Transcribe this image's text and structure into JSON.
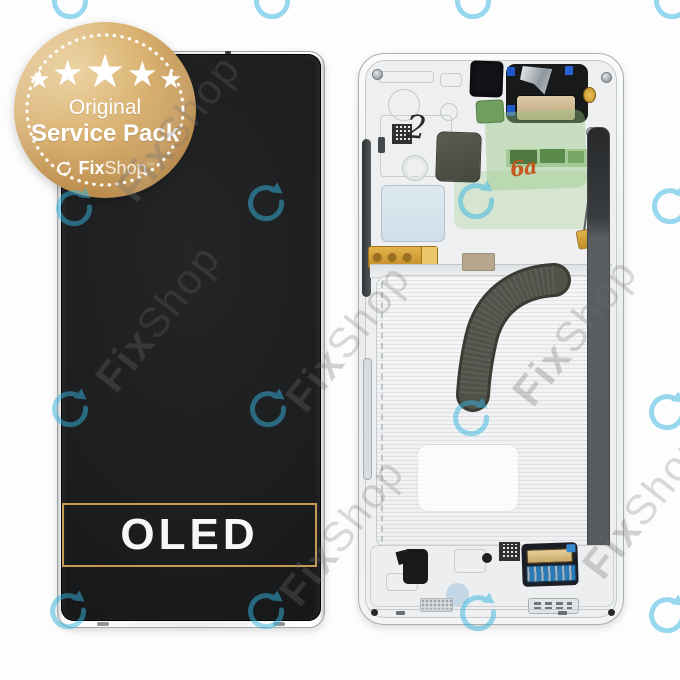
{
  "badge": {
    "stars": {
      "count": 5,
      "glyph": "★"
    },
    "title": "Original",
    "subtitle": "Service Pack",
    "brand": {
      "icon": "circular-arrow-icon",
      "fix": "Fix",
      "shop": "Shop",
      "tm": "™"
    },
    "colors": {
      "gold_light": "#ecd2a0",
      "gold_mid": "#c9a263",
      "gold_dark": "#9c7036",
      "text": "#ffffff"
    }
  },
  "left_phone": {
    "label": "OLED",
    "label_border_color": "#c79a57",
    "screen_color": "#1c1d1f",
    "frame_color": "#f4f5f6"
  },
  "right_phone": {
    "handwritten_number": "2",
    "handwritten_scribble": "6a",
    "frame_color": "#eef0f1",
    "pcb_green": "#8fbf7a",
    "flex_cable_color": "#4b4d44",
    "gold_flex_color": "#d9a83c",
    "connector_blue": "#2a7ab5",
    "speaker_membrane": "#c9b38c"
  },
  "watermarks": {
    "brand_fix": "Fix",
    "brand_shop": "Shop",
    "arrow_icon": "circular-arrow-icon",
    "arrow_color": "#35b5e0",
    "text_color": "#6f6f6f"
  }
}
